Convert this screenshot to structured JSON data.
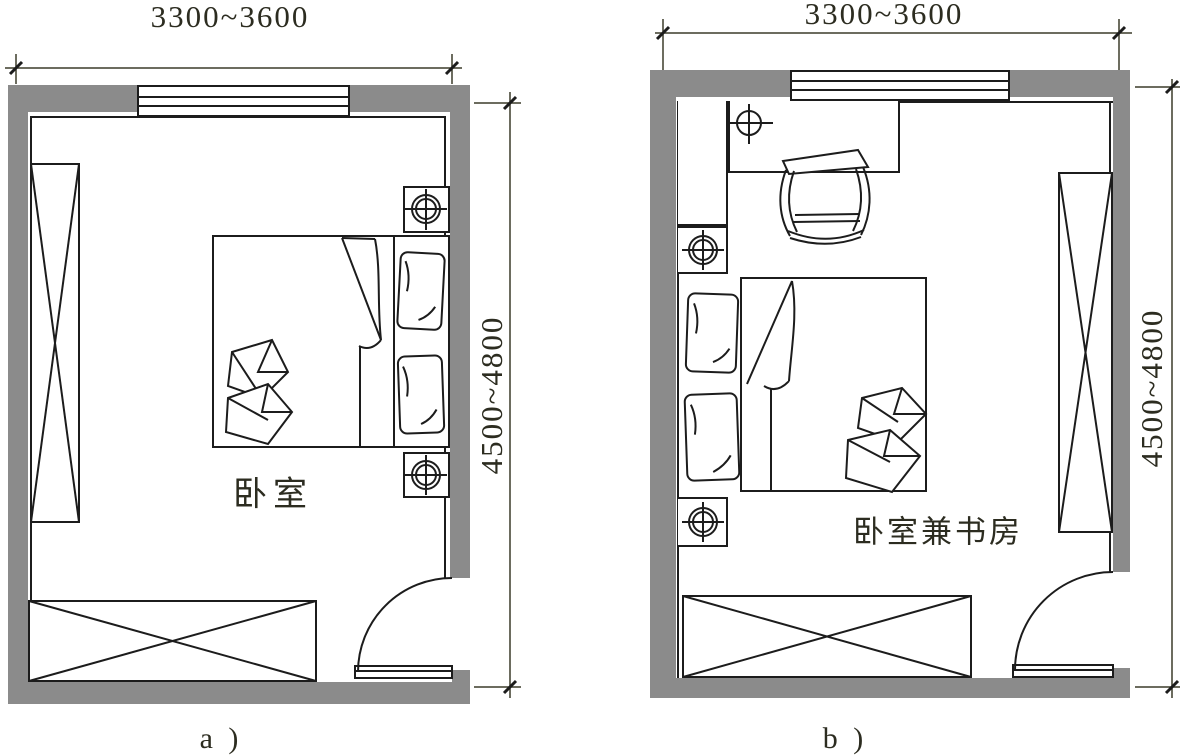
{
  "page": {
    "background": "#ffffff"
  },
  "colors": {
    "wall_fill": "#8b8b8b",
    "line": "#1c1c1c",
    "dimension_line": "#3c3c2a",
    "text": "#2c2c20"
  },
  "plans": {
    "a": {
      "label": "a )",
      "room_label": "卧室",
      "width_dim": "3300~3600",
      "height_dim": "4500~4800"
    },
    "b": {
      "label": "b )",
      "room_label": "卧室兼书房",
      "width_dim": "3300~3600",
      "height_dim": "4500~4800"
    }
  }
}
